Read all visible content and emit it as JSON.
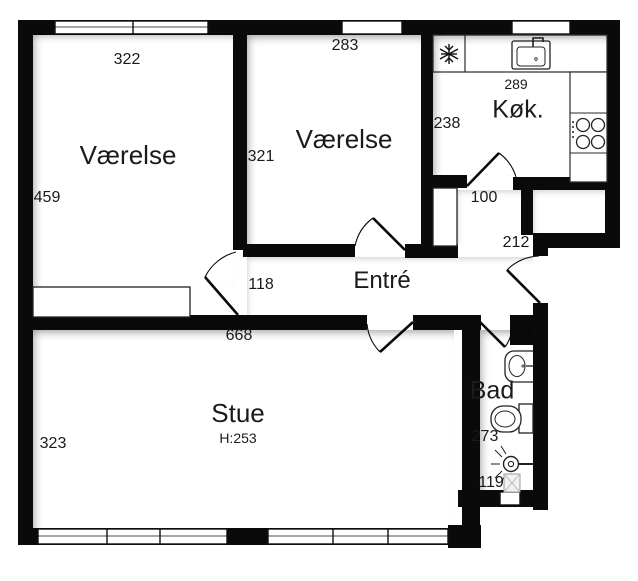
{
  "rooms": {
    "vaerelse1": {
      "label": "Værelse",
      "width_cm": "322",
      "depth_cm": "459"
    },
    "vaerelse2": {
      "label": "Værelse",
      "width_cm": "283",
      "depth_cm": "321"
    },
    "kitchen": {
      "label": "Køk.",
      "width_cm": "289",
      "depth_cm": "238"
    },
    "entre": {
      "label": "Entré",
      "hall_width_cm": "100",
      "entry_width_cm": "212",
      "door_gap_cm": "118"
    },
    "stue": {
      "label": "Stue",
      "ceiling_height": "H:253",
      "width_cm": "668",
      "depth_cm": "323"
    },
    "bad": {
      "label": "Bad",
      "depth_cm": "273",
      "width_cm": "119"
    }
  },
  "icons": {
    "fridge": "snowflake",
    "kitchen_sink": "sink-with-faucet",
    "stove": "four-burners",
    "bath_sink": "washbasin",
    "toilet": "toilet",
    "shower": "shower-head",
    "drain": "floor-drain"
  },
  "colors": {
    "wall": "#0a0a0a",
    "background": "#ffffff",
    "text": "#1a1a1a"
  }
}
